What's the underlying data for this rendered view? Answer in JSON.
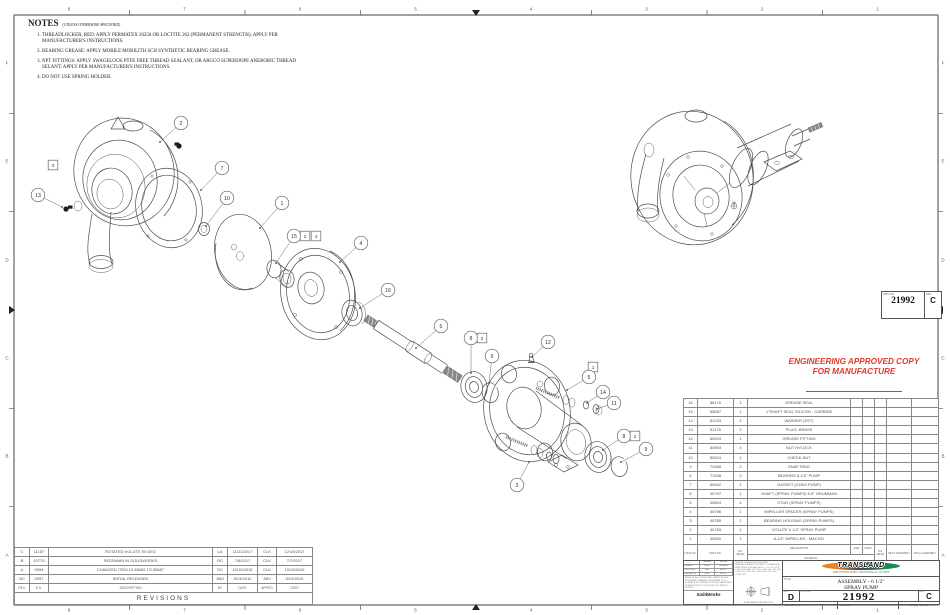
{
  "accent_red": "#e2392c",
  "notes": {
    "heading": "NOTES",
    "qualifier": "(UNLESS OTHERWISE SPECIFIED)",
    "items": [
      "THREADLOCKER, RED: APPLY PERMATEX 26250 OR LOCTITE 262 (PERMANENT STRENGTH); APPLY PER MANUFACTURER'S INSTRUCTIONS.",
      "BEARING GREASE: APPLY MOBILE MOBILITH SCH SYNTHETIC BEARING GREASE.",
      "NPT FITTINGS: APPLY SWAGELOCK PTFE FREE THREAD SEALANT, OR ARGCO SUPERDOPE ANEROBIC THREAD SELANT; APPLY PER MANUFACTURER'S INSTRUCTIONS.",
      "DO NOT USE SPRING HOLDER."
    ]
  },
  "stamp": {
    "line1": "ENGINEERING APPROVED COPY",
    "line2": "FOR MANUFACTURE"
  },
  "ref_box": {
    "dwg_label": "DWG NO",
    "dwg_no": "21992",
    "rev_label": "REV",
    "rev": "C"
  },
  "bom": {
    "headers": {
      "item": "ITEM NO.",
      "part": "PART NO.",
      "reqd": "NO. REQD",
      "desc": "DESCRIPTION",
      "material": "MATERIAL",
      "size": "SIZE",
      "spec": "SPEC.",
      "reqd2": "NO. REQD",
      "next": "NEXT ASSEMBLY",
      "final": "FINAL ASSEMBLY"
    },
    "rows": [
      [
        "16",
        "86176",
        "1",
        "GREASE SEAL"
      ],
      [
        "15",
        "85687",
        "1",
        "1\"SHAFT SEAL SILICON - CARBIDE"
      ],
      [
        "14",
        "81233",
        "4",
        "WASHER  (SST)"
      ],
      [
        "13",
        "81175",
        "2",
        "PLUG, BRASS"
      ],
      [
        "12",
        "80603",
        "1",
        "GREASE FITTING"
      ],
      [
        "11",
        "80563",
        "4",
        "NUT  NYLOCK"
      ],
      [
        "10",
        "80524",
        "1",
        "CHECK NUT"
      ],
      [
        "9",
        "74568",
        "2",
        "SNAP RING"
      ],
      [
        "8",
        "71548",
        "2",
        "BEARING  6-1/2\" PUMP"
      ],
      [
        "7",
        "60662",
        "1",
        "GASKET (21363 PUMP)"
      ],
      [
        "6",
        "40797",
        "1",
        "SHAFT (SPRAY PUMPS) 6.5\" GRUMMAN"
      ],
      [
        "5",
        "40804",
        "4",
        "STUD (SPRAY PUMPS)"
      ],
      [
        "4",
        "40786",
        "1",
        "IMPELLER SPACER (SPRAY PUMPS)"
      ],
      [
        "3",
        "40785",
        "1",
        "BEARING HOUSING (SPRAY PUMPS)"
      ],
      [
        "2",
        "40783",
        "1",
        "VOLUTE 6 1/2\" SPRAY PUMP"
      ],
      [
        "1",
        "45500",
        "1",
        "6-1/2\" IMPELLER - MACH'D"
      ]
    ]
  },
  "revisions": {
    "title": "REVISIONS",
    "headers": [
      "REV.",
      "E.O.",
      "DESCRIPTION",
      "BY",
      "DATE",
      "APPR'D",
      "DATE"
    ],
    "rows": [
      [
        "C",
        "11187",
        "ROTATED VOLUTE 90 DEG",
        "LA",
        "11/21/2017",
        "CLK",
        "12/15/2017"
      ],
      [
        "B",
        "10770",
        "REDRAWN IN SOLIDWORKS",
        "RC",
        "7/6/2017",
        "CLK",
        "7/7/2017"
      ],
      [
        "A",
        "9394",
        "CHANGED ITEM 15 85689 TO 85687",
        "RC",
        "10/19/2016",
        "CLK",
        "10/19/2016"
      ],
      [
        "NC",
        "0097",
        "INITIAL RELEASED",
        "JMV",
        "5/13/2010",
        "JMV",
        "5/13/2010"
      ]
    ]
  },
  "title_block": {
    "name_col": "NAME",
    "date_col": "DATE",
    "approvals": [
      {
        "role": "DRAWN",
        "name": "ZMV",
        "date": "5/13/10"
      },
      {
        "role": "CHECKED",
        "name": "RB",
        "date": "4/6/17"
      },
      {
        "role": "ENG APPR.",
        "name": "CLK",
        "date": "4/7/17"
      }
    ],
    "fine_print": "REMOVE ALL BURRS AND SHARP EDGES. INTERPRET DRAWING PER ASME Y14.5. SURFACE ROUGHNESS 250. ALL MACHINED SURFACES NOT TO EXCEED 63 UNLESS NOTED.",
    "solidworks": "SolidWorks",
    "tolerances": "UNLESS OTHERWISE SPECIFIED DIMENSIONS ARE IN INCHES. TOLERANCES: FRACTIONS ±1/16  ANGLES ±1°  .XX ±.01  .XXX ±.005  HOLE DIA: .125-.250 +.004/-.001  .251-.500 +.005/-.001  .501-.750 +.006/-.001  .751-1.000 +.008/-.002",
    "projection": "THIRD ANGLE PROJECTION",
    "company": "TRANSLAND",
    "address": "1206 HATTON ROAD, WICHITA FALLS, TX 76302",
    "title_label": "TITLE:",
    "title_line1": "ASSEMBLY - 6 1/2\"",
    "title_line2": "SPRAY PUMP",
    "size_label": "SIZE",
    "size": "D",
    "dwg_label": "DWG. NO.",
    "dwg_no": "21992",
    "rev_label": "REV",
    "rev": "C",
    "scale": "SCALE: NTS",
    "model": "MODEL:",
    "sheet": "SHEET 1 OF 1"
  },
  "zones": {
    "top_numbers": [
      "8",
      "7",
      "6",
      "5",
      "4",
      "3",
      "2",
      "1"
    ],
    "bottom_numbers": [
      "8",
      "7",
      "6",
      "5",
      "4",
      "3",
      "2",
      "1"
    ],
    "left_letters": [
      "F",
      "E",
      "D",
      "C",
      "B",
      "A"
    ],
    "right_letters": [
      "F",
      "E",
      "D",
      "C",
      "B",
      "A"
    ]
  },
  "drawing": {
    "balloons": [
      {
        "t": "c",
        "l": "2",
        "x": 181,
        "y": 123,
        "tx": 160,
        "ty": 142
      },
      {
        "t": "s",
        "l": "3",
        "x": 53,
        "y": 165
      },
      {
        "t": "c",
        "l": "13",
        "x": 38,
        "y": 195,
        "tx": 62,
        "ty": 207
      },
      {
        "t": "c",
        "l": "7",
        "x": 222,
        "y": 168,
        "tx": 201,
        "ty": 190
      },
      {
        "t": "c",
        "l": "10",
        "x": 227,
        "y": 198,
        "tx": 206,
        "ty": 226
      },
      {
        "t": "c",
        "l": "1",
        "x": 282,
        "y": 203,
        "tx": 260,
        "ty": 228
      },
      {
        "t": "c",
        "l": "15",
        "x": 294,
        "y": 236,
        "tx": 276,
        "ty": 263
      },
      {
        "t": "s",
        "l": "2",
        "x": 305,
        "y": 236
      },
      {
        "t": "s",
        "l": "4",
        "x": 316,
        "y": 236
      },
      {
        "t": "c",
        "l": "4",
        "x": 361,
        "y": 243,
        "tx": 340,
        "ty": 262
      },
      {
        "t": "c",
        "l": "16",
        "x": 388,
        "y": 290,
        "tx": 360,
        "ty": 308
      },
      {
        "t": "c",
        "l": "6",
        "x": 441,
        "y": 326,
        "tx": 416,
        "ty": 348
      },
      {
        "t": "c",
        "l": "8",
        "x": 471,
        "y": 338,
        "tx": 471,
        "ty": 373
      },
      {
        "t": "s",
        "l": "2",
        "x": 482,
        "y": 338
      },
      {
        "t": "c",
        "l": "9",
        "x": 492,
        "y": 356,
        "tx": 489,
        "ty": 383
      },
      {
        "t": "c",
        "l": "12",
        "x": 548,
        "y": 342,
        "tx": 532,
        "ty": 357
      },
      {
        "t": "s",
        "l": "1",
        "x": 593,
        "y": 367
      },
      {
        "t": "c",
        "l": "5",
        "x": 589,
        "y": 377,
        "tx": 567,
        "ty": 390
      },
      {
        "t": "c",
        "l": "14",
        "x": 603,
        "y": 392,
        "tx": 587,
        "ty": 403
      },
      {
        "t": "c",
        "l": "11",
        "x": 614,
        "y": 403,
        "tx": 597,
        "ty": 409
      },
      {
        "t": "c",
        "l": "8",
        "x": 624,
        "y": 436,
        "tx": 603,
        "ty": 450
      },
      {
        "t": "s",
        "l": "2",
        "x": 635,
        "y": 436
      },
      {
        "t": "c",
        "l": "9",
        "x": 646,
        "y": 449,
        "tx": 621,
        "ty": 462
      },
      {
        "t": "c",
        "l": "3",
        "x": 517,
        "y": 485,
        "tx": 529,
        "ty": 462
      }
    ]
  }
}
